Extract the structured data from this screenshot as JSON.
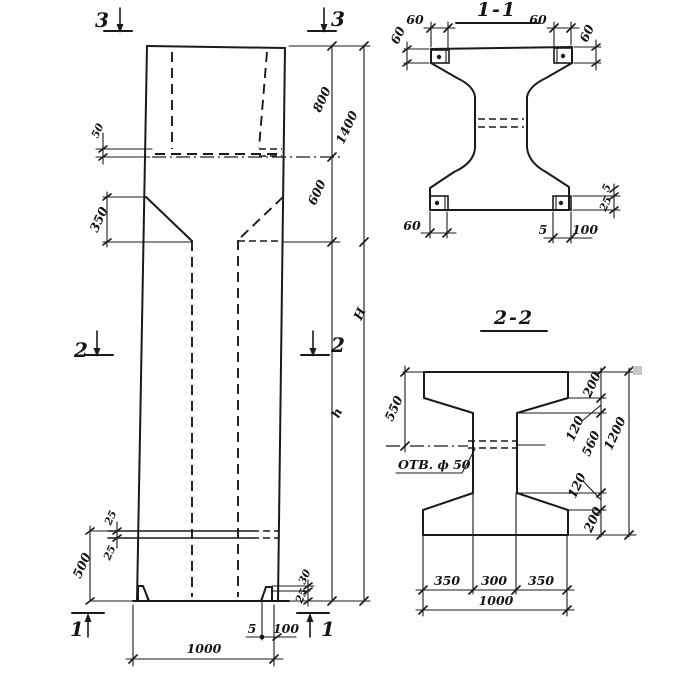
{
  "drawing": {
    "ink": "#1a1a1a",
    "background": "#ffffff",
    "elevation": {
      "marker_top_left": "3",
      "marker_top_right": "3",
      "marker_mid_left": "2",
      "marker_mid_right": "2",
      "marker_bottom_left": "1",
      "marker_bottom_right": "1",
      "dim_head_plate": "50",
      "dim_taper": "350",
      "dim_head_upper": "800",
      "dim_head_taper": "600",
      "dim_head_total": "1400",
      "dim_shaft": "h",
      "dim_total": "H",
      "dim_slot_upper": "25",
      "dim_slot_lower": "25",
      "dim_base": "500",
      "dim_foot_rise": "30",
      "dim_foot_thk": "25",
      "dim_foot_weld": "5",
      "dim_foot_plate": "100",
      "dim_width": "1000"
    },
    "section1": {
      "title": "1-1",
      "dim_tl_w": "60",
      "dim_tl_h": "60",
      "dim_tr_w": "60",
      "dim_tr_h": "60",
      "dim_bl_w": "60",
      "dim_br_weld": "5",
      "dim_br_plate": "100",
      "dim_r_rise": "5",
      "dim_r_thk": "25"
    },
    "section2": {
      "title": "2-2",
      "hole_label": "ОТВ. ф 50",
      "dim_left": "550",
      "dim_top_flange": "200",
      "dim_top_taper": "120",
      "dim_web": "560",
      "dim_bottom_taper": "120",
      "dim_bottom_flange": "200",
      "dim_height": "1200",
      "dim_bottom_left": "350",
      "dim_bottom_mid": "300",
      "dim_bottom_right": "350",
      "dim_width": "1000"
    }
  }
}
